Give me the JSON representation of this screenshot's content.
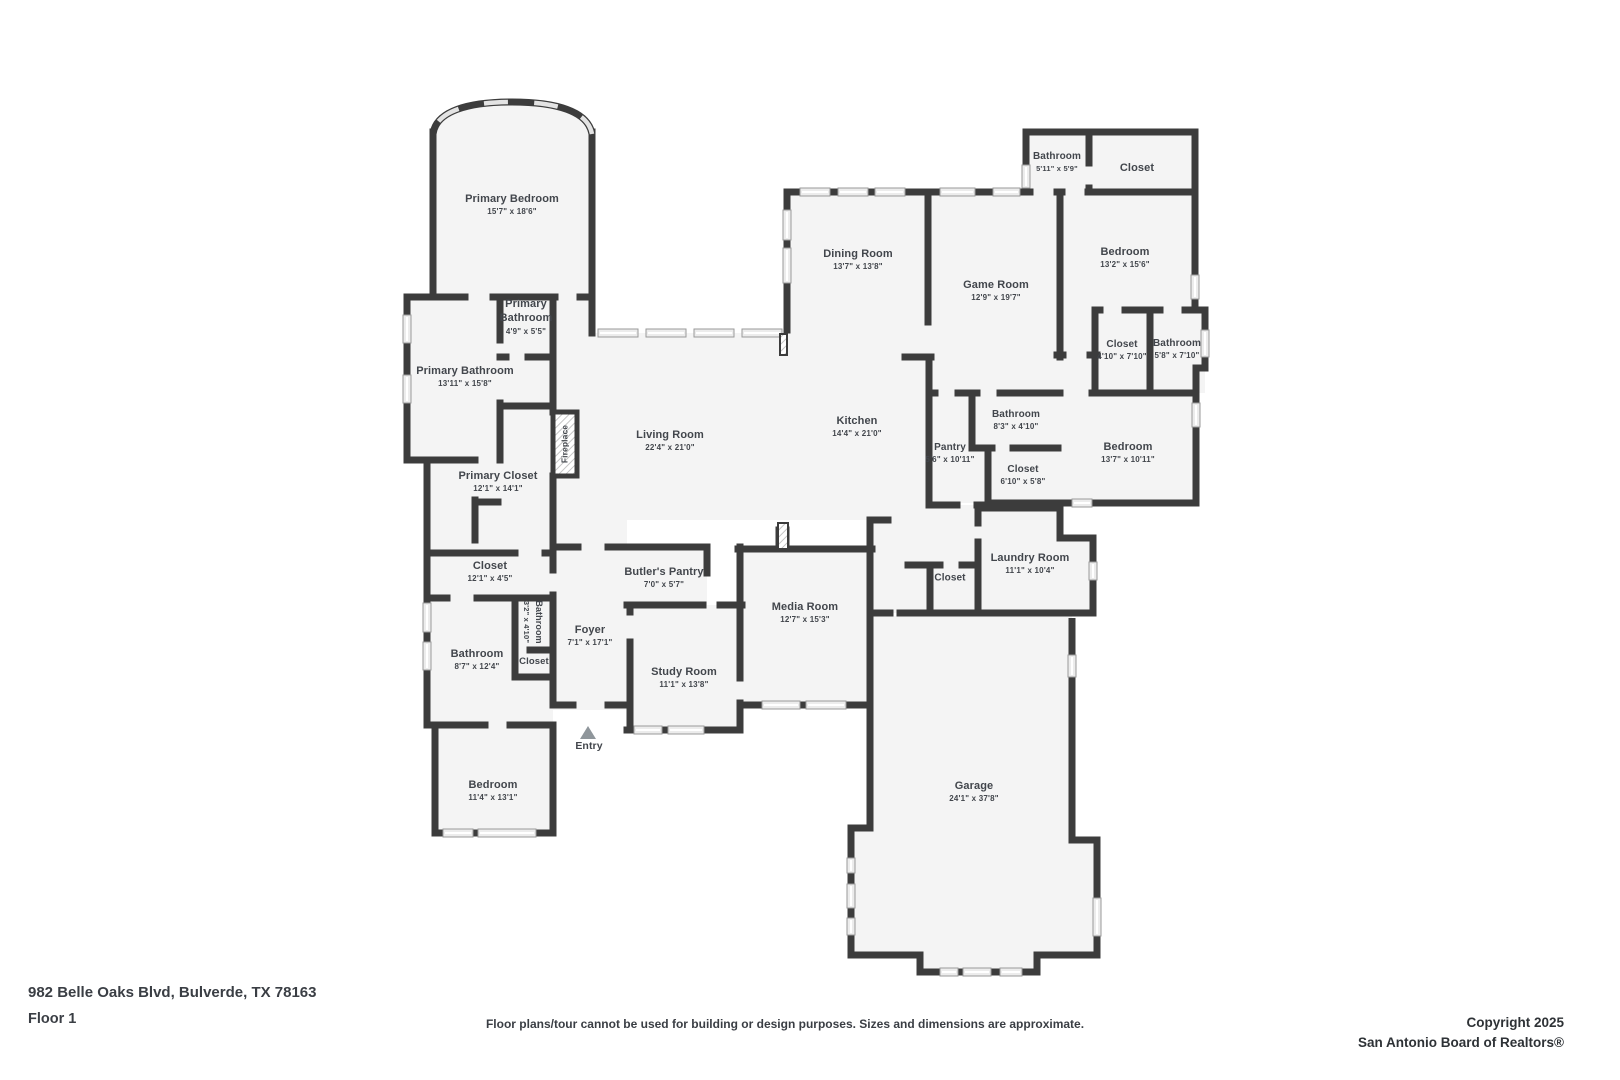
{
  "footer": {
    "address": "982 Belle Oaks Blvd, Bulverde, TX 78163",
    "floor": "Floor 1",
    "disclaimer": "Floor plans/tour cannot be used for building or design purposes. Sizes and dimensions are approximate.",
    "copyright_line1": "Copyright 2025",
    "copyright_line2": "San Antonio Board of Realtors®"
  },
  "colors": {
    "wall": "#3c3c3c",
    "room_fill": "#f4f4f4",
    "window_fill": "#ececec",
    "window_stroke": "#9a9a9a",
    "text": "#42464c",
    "entry_marker": "#8f969b"
  },
  "annotations": {
    "entry": "Entry",
    "fireplace": "Fireplace"
  },
  "rooms": [
    {
      "id": "primary-bedroom",
      "name": "Primary Bedroom",
      "dims": "15'7\" x 18'6\""
    },
    {
      "id": "primary-bathroom-small",
      "name": "Primary Bathroom",
      "dims": "4'9\" x 5'5\""
    },
    {
      "id": "primary-bathroom",
      "name": "Primary Bathroom",
      "dims": "13'11\" x 15'8\""
    },
    {
      "id": "primary-closet",
      "name": "Primary Closet",
      "dims": "12'1\" x 14'1\""
    },
    {
      "id": "closet-west",
      "name": "Closet",
      "dims": "12'1\" x 4'5\""
    },
    {
      "id": "bathroom-small",
      "name": "Bathroom",
      "dims": "3'2\" x 4'10\""
    },
    {
      "id": "bathroom-west",
      "name": "Bathroom",
      "dims": "8'7\" x 12'4\""
    },
    {
      "id": "closet-inner",
      "name": "Closet",
      "dims": ""
    },
    {
      "id": "bedroom-west",
      "name": "Bedroom",
      "dims": "11'4\" x 13'1\""
    },
    {
      "id": "foyer",
      "name": "Foyer",
      "dims": "7'1\" x 17'1\""
    },
    {
      "id": "butlers-pantry",
      "name": "Butler's Pantry",
      "dims": "7'0\" x 5'7\""
    },
    {
      "id": "study-room",
      "name": "Study Room",
      "dims": "11'1\" x 13'8\""
    },
    {
      "id": "media-room",
      "name": "Media Room",
      "dims": "12'7\" x 15'3\""
    },
    {
      "id": "living-room",
      "name": "Living Room",
      "dims": "22'4\" x 21'0\""
    },
    {
      "id": "kitchen",
      "name": "Kitchen",
      "dims": "14'4\" x 21'0\""
    },
    {
      "id": "dining-room",
      "name": "Dining Room",
      "dims": "13'7\" x 13'8\""
    },
    {
      "id": "game-room",
      "name": "Game Room",
      "dims": "12'9\" x 19'7\""
    },
    {
      "id": "bathroom-north",
      "name": "Bathroom",
      "dims": "5'11\" x 5'9\""
    },
    {
      "id": "closet-north",
      "name": "Closet",
      "dims": ""
    },
    {
      "id": "bedroom-northeast",
      "name": "Bedroom",
      "dims": "13'2\" x 15'6\""
    },
    {
      "id": "closet-northeast",
      "name": "Closet",
      "dims": "4'10\" x 7'10\""
    },
    {
      "id": "bathroom-northeast",
      "name": "Bathroom",
      "dims": "5'8\" x 7'10\""
    },
    {
      "id": "bathroom-center",
      "name": "Bathroom",
      "dims": "8'3\" x 4'10\""
    },
    {
      "id": "pantry",
      "name": "Pantry",
      "dims": "5'6\" x 10'11\""
    },
    {
      "id": "closet-center",
      "name": "Closet",
      "dims": "6'10\" x 5'8\""
    },
    {
      "id": "bedroom-east",
      "name": "Bedroom",
      "dims": "13'7\" x 10'11\""
    },
    {
      "id": "laundry-room",
      "name": "Laundry Room",
      "dims": "11'1\" x 10'4\""
    },
    {
      "id": "closet-hall",
      "name": "Closet",
      "dims": ""
    },
    {
      "id": "garage",
      "name": "Garage",
      "dims": "24'1\" x 37'8\""
    }
  ]
}
